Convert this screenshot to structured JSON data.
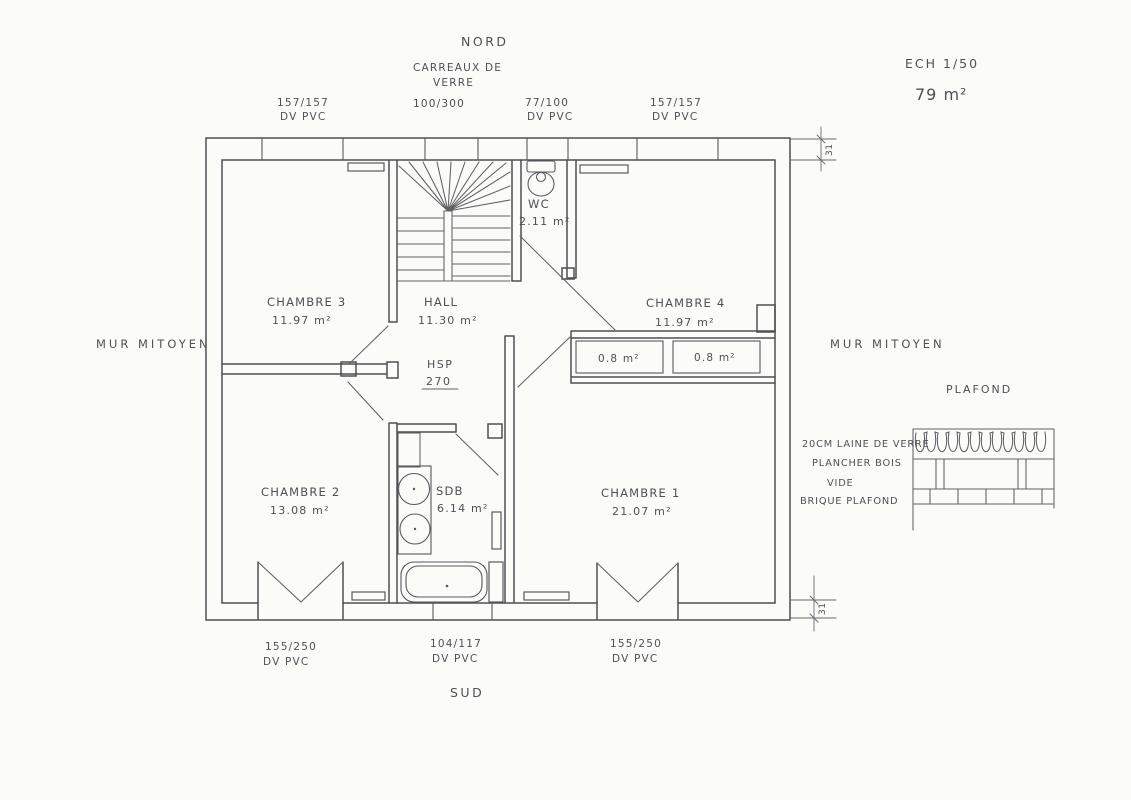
{
  "compass": {
    "north": "NORD",
    "south": "SUD"
  },
  "title_block": {
    "scale": "ECH 1/50",
    "area": "79 m²"
  },
  "party_walls": {
    "left": "MUR MITOYEN",
    "right": "MUR MITOYEN"
  },
  "windows": {
    "top_left": {
      "size": "157/157",
      "frame": "DV PVC"
    },
    "glass_blocks": {
      "name_line1": "CARREAUX DE",
      "name_line2": "VERRE",
      "size": "100/300"
    },
    "top_wc": {
      "size": "77/100",
      "frame": "DV PVC"
    },
    "top_right": {
      "size": "157/157",
      "frame": "DV PVC"
    },
    "bottom_left": {
      "size": "155/250",
      "frame": "DV PVC"
    },
    "bottom_middle": {
      "size": "104/117",
      "frame": "DV PVC"
    },
    "bottom_right": {
      "size": "155/250",
      "frame": "DV PVC"
    }
  },
  "rooms": {
    "chambre3": {
      "name": "CHAMBRE 3",
      "area": "11.97 m²"
    },
    "hall": {
      "name": "HALL",
      "area": "11.30 m²"
    },
    "wc": {
      "name": "WC",
      "area": "2.11 m²"
    },
    "chambre4": {
      "name": "CHAMBRE 4",
      "area": "11.97 m²"
    },
    "chambre2": {
      "name": "CHAMBRE 2",
      "area": "13.08 m²"
    },
    "sdb": {
      "name": "SDB",
      "area": "6.14 m²"
    },
    "chambre1": {
      "name": "CHAMBRE 1",
      "area": "21.07 m²"
    },
    "closet_left": {
      "area": "0.8 m²"
    },
    "closet_right": {
      "area": "0.8 m²"
    }
  },
  "annotations": {
    "ceiling_height": {
      "label": "HSP",
      "value": "270"
    },
    "wall_thickness_top": "31",
    "wall_thickness_bottom": "31"
  },
  "ceiling_detail": {
    "title": "PLAFOND",
    "layer1": "20CM LAINE DE VERRE",
    "layer2": "PLANCHER BOIS",
    "layer3": "VIDE",
    "layer4": "BRIQUE PLAFOND"
  }
}
